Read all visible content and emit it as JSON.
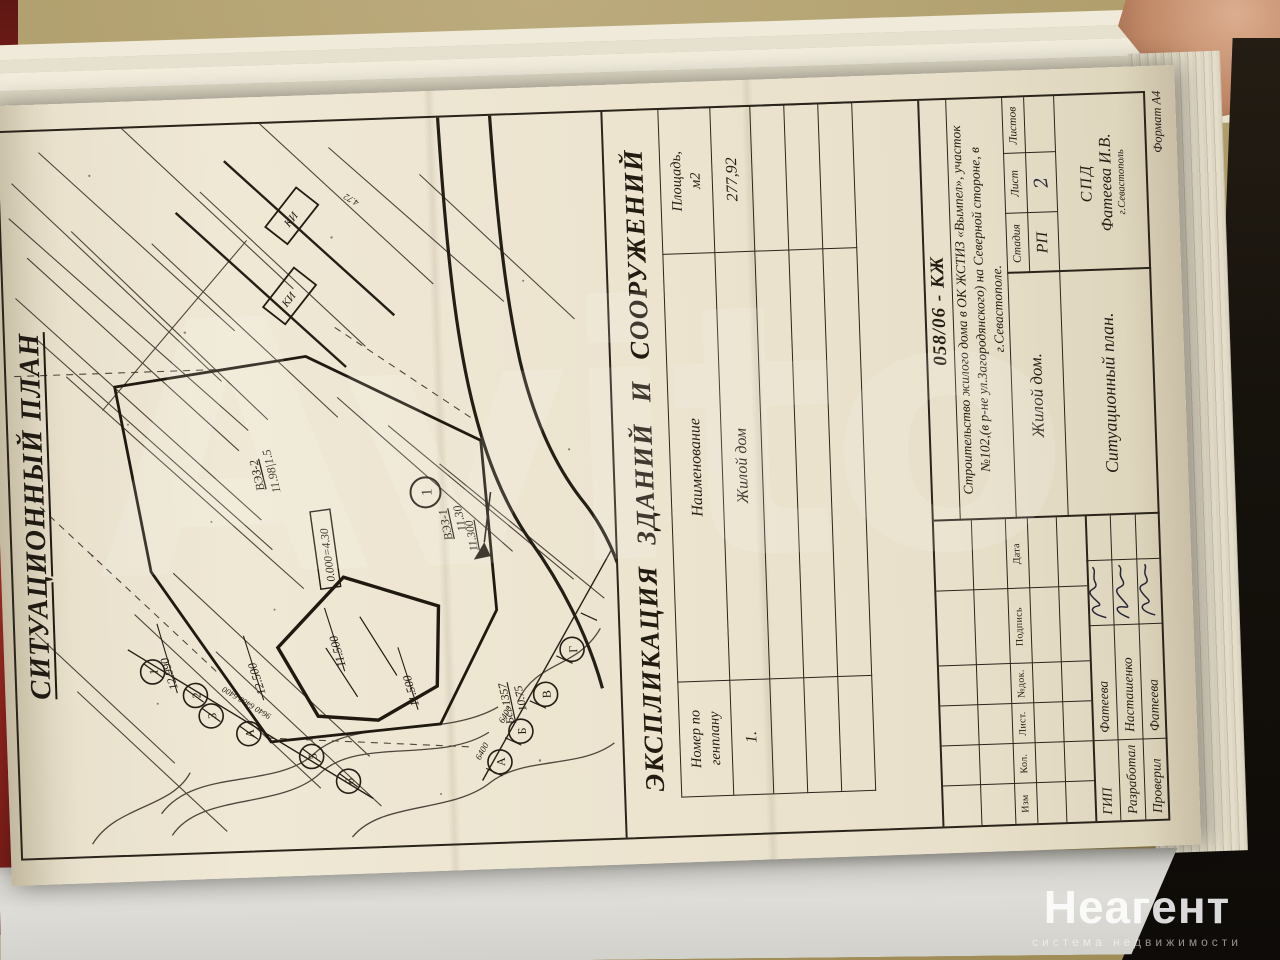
{
  "colors": {
    "paper": "#ebe3cf",
    "ink": "#2b241a",
    "folder_red": "#c23a2d",
    "table_surface": "#ac9a66",
    "shadow_dark": "#16120c"
  },
  "watermarks": {
    "big": "Avito",
    "logo": "Неагент",
    "logo_sub": "система недвижимости"
  },
  "plan": {
    "title": "СИТУАЦИОННЫЙ ПЛАН",
    "labels": {
      "vez2": "ВЭЗ-2",
      "vez2_val": "11.98|1.5",
      "vez1": "ВЭЗ-1",
      "vez1_val": "11.30",
      "flag_elev": "11.300",
      "zero_mark": "0.000=4.30",
      "bldg_no": "1",
      "dim_12990": "12.990",
      "dim_12500": "12.500",
      "dim_11500a": "11.500",
      "dim_11500b": "11.500",
      "bench": "Бс.-1357",
      "bench_val": "10.75",
      "chainA_dims": "9640 6400 6400",
      "chainB_dim1": "6400",
      "chainB_dim2": "6400",
      "ki1": "КИ",
      "ki2": "КИ",
      "spot": "4.72",
      "stationsA": [
        "1",
        "2",
        "3",
        "А",
        "5",
        "6"
      ],
      "stationsB": [
        "А",
        "Б",
        "В",
        "Г"
      ]
    }
  },
  "explication": {
    "title": "ЭКСПЛИКАЦИЯ ЗДАНИЙ И СООРУЖЕНИЙ",
    "col_number_l1": "Номер по",
    "col_number_l2": "генплану",
    "col_name": "Наименование",
    "col_area_l1": "Площадь,",
    "col_area_l2": "м2",
    "row_number": "1.",
    "row_name": "Жилой дом",
    "row_area": "277,92"
  },
  "stamp": {
    "doc_number": "058/06 - КЖ",
    "project_line1": "Строительство жилого дома в ОК ЖСТИЗ «Вымпел», участок",
    "project_line2": "№102,(в р-не ул.Загородянского) на Северной стороне, в",
    "project_line3": "г.Севастополе.",
    "object_name": "Жилой дом.",
    "drawing_name": "Ситуационный план.",
    "stage_label": "Стадия",
    "sheet_label": "Лист",
    "sheets_label": "Листов",
    "stage_value": "РП",
    "sheet_value": "2",
    "org_line1": "СПД",
    "org_line2": "Фатеева И.В.",
    "org_line3": "г.Севастополь",
    "rev_cols": [
      "Изм",
      "Кол.",
      "Лист.",
      "№док.",
      "Подпись",
      "Дата"
    ],
    "roles": [
      {
        "role": "ГИП",
        "name": "Фатеева"
      },
      {
        "role": "Разработал",
        "name": "Насташенко"
      },
      {
        "role": "Проверил",
        "name": "Фатеева"
      }
    ],
    "format_note": "Формат А4"
  }
}
